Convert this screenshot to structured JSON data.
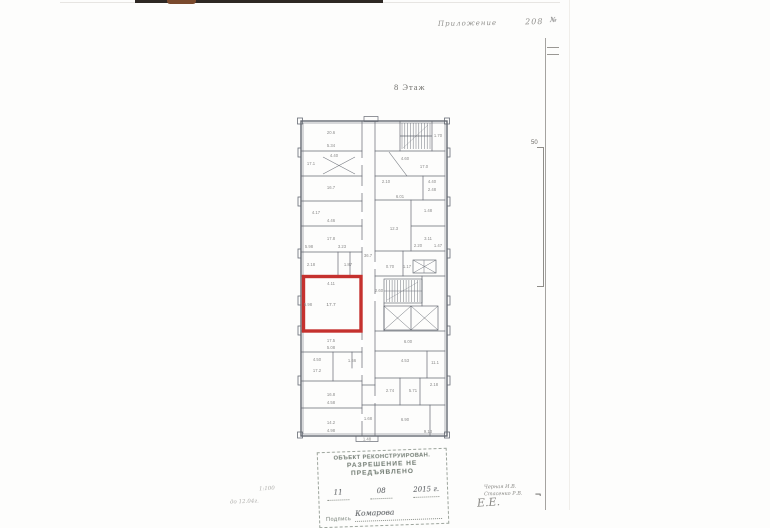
{
  "page": {
    "floor_title": "8 Этаж",
    "top_note": "Приложение",
    "top_note_number": "208",
    "margin_mark": "№",
    "dim_label": "50",
    "scale_note": "1:100",
    "date_note": "до 12.04г.",
    "corner_mark": "¬"
  },
  "stamp": {
    "line1": "ОБЪЕКТ РЕКОНСТРУИРОВАН.",
    "line2": "РАЗРЕШЕНИЕ НЕ",
    "line3": "ПРЕДЪЯВЛЕНО",
    "date_day": "11",
    "date_month": "08",
    "date_year": "2015 г.",
    "signature_label": "Подпись",
    "signature": "Комарова"
  },
  "signatures": {
    "line1": "Черная И.В.",
    "line2": "Стасенко Р.В.",
    "flourish": "Е.Е."
  },
  "colors": {
    "highlight": "#c5312e",
    "wall": "#555a64",
    "stamp_ink": "#6e786f"
  },
  "plan": {
    "highlighted_room_area": "17.7",
    "labels": [
      "20.6",
      "5.34",
      "17.1",
      "4.40",
      "16.7",
      "4.17",
      "4.46",
      "17.8",
      "5.98",
      "3.23",
      "2.18",
      "1.87",
      "4.11",
      "17.7",
      "5.98",
      "17.5",
      "5.08",
      "4.50",
      "1.66",
      "17.2",
      "16.8",
      "4.58",
      "14.2",
      "4.98",
      "1.70",
      "4.60",
      "17.0",
      "2.10",
      "6.01",
      "4.40",
      "2.48",
      "12.3",
      "1.48",
      "3.11",
      "2.20",
      "1.47",
      "0.70",
      "1.17",
      "2.60",
      "6.00",
      "4.53",
      "11.1",
      "2.74",
      "5.71",
      "2.18",
      "6.90",
      "9.13",
      "1.48",
      "36.7",
      "1.68"
    ]
  }
}
